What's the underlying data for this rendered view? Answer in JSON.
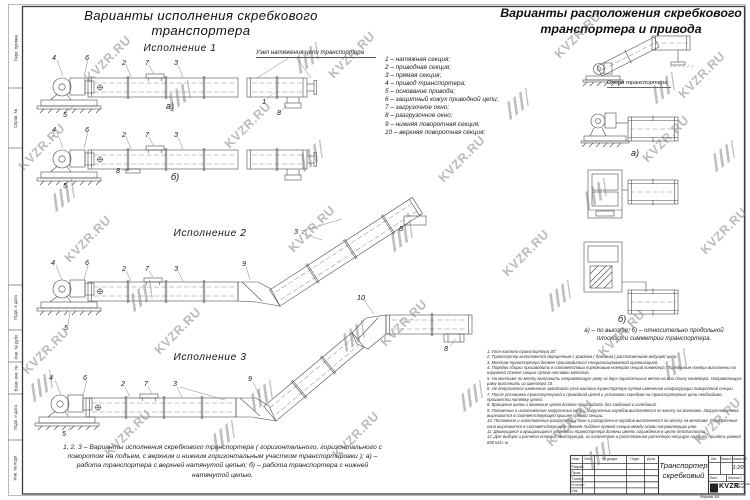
{
  "watermark": {
    "text": "KVZR.RU"
  },
  "titles": {
    "left": "Варианты исполнения скребкового транспортера",
    "right": "Варианты расположения скребкового\nтранспортера и привода"
  },
  "detail_heading": "Узел натяжения цепи транспортера",
  "legend": {
    "items": [
      "1 –  натяжная секция;",
      "2 –  приводная секция;",
      "3 –  прямая секция;",
      "4 –  привод транспортера;",
      "5 –  основание привода;",
      "6 –  защитный кожух приводной цепи;",
      "7 –  загрузочное окно;",
      "8 –  разгрузочное окно;",
      "9 –  нижняя поворотная секция;",
      "10 –  верхняя поворотная секция;"
    ]
  },
  "executions": {
    "e1": "Исполнение  1",
    "e2": "Исполнение  2",
    "e3": "Исполнение  3"
  },
  "sub_labels": {
    "a": "а)",
    "b": "б)"
  },
  "callouts": {
    "n1": "1",
    "n2": "2",
    "n3": "3",
    "n4": "4",
    "n5": "5",
    "n6": "6",
    "n7": "7",
    "n8": "8",
    "n9": "9",
    "n10": "10"
  },
  "right_panel": {
    "support_label": "Опора транспортера",
    "caption": "а) –  по высоте;  б) –  относительно продольной\nплоскости симметрии транспортера."
  },
  "bottom_caption": "1, 2, 3 –  Варианты исполнения скребкового транспортера ( горизонтального, горизонтального с\nповоротом на подъем, с верхним и нижним горизонтальным участком транспортировки );  а) –\nработа транспортера с верхней натянутой цепью;  б) –  работа транспортера с нижней\nнатянутой цепью.",
  "notes": {
    "items": [
      "1. Угол наклона транспортера 30°.",
      "2. Транспортер выполняется двухцепным с крайним ( боковым ) расположением ведущей цепи.",
      "3. Монтаж транспортера должен производиться специализированной организацией.",
      "4. Порядок сборки производить в соответствии порядковым номерам секций конвейера. Порядковые номера выполнены на наружной стенке секции путем наплавки металла.",
      "5. На монтаже по месту выполнить направляющую раму из двух параллельных веток на всю длину конвейера. Направляющую раму выполнить из швеллера 10.",
      "6. Не допускается изменение заводского угла наклона транспортера путем изменения конфигурации поворотной секции.",
      "7. После установки транспортерной и приводной цепей и установки скребков на транспортерные цепи необходимо произвести натяжку цепей.",
      "8. Вращение валов и движение цепей должно происходить без заеданий и колебаний.",
      "9. Положение и изготовление загрузочных окон и загрузочных коробов выполняется по месту на монтаже. Загрузочные окна вырезаются в соответствующей крышке прямой секции.",
      "10. Положение и изготовление разгрузочных окон и разгрузочных коробов выполняется по месту на монтаже. Разгрузочные окна вырезаются в соответствующем нижнем поддоне прямой секции между осями направляющих рам.",
      "11. Движущиеся и вращающиеся элементы транспортера должны иметь ограждения в целях безопасности.",
      "12. Для выбора и расчета опорных конструкций, их количества и расположения расчетную несущую нагрузку принять равной 600 кг/п. м."
    ]
  },
  "title_block": {
    "doc_title": "Транспортер\nскребковый",
    "cols": [
      "Изм.",
      "Лист",
      "№ докум.",
      "Подп.",
      "Дата"
    ],
    "rows": [
      "Разраб.",
      "Пров.",
      "Т.контр.",
      "Н.контр.",
      "Утв."
    ],
    "lit_label": "Лит.",
    "mass_label": "Масса",
    "scale_label": "Масштаб",
    "scale_value": "1:20",
    "sheet_label": "Лист",
    "sheets_label": "Листов",
    "sheets_value": "1",
    "logo_text": "KVZR",
    "logo_sub": "КОТЕЛЬНЫЙ ЗАВОД",
    "format_label": "Формат А3"
  },
  "margin_labels": {
    "items": [
      "Перв. примен.",
      "Справ. №",
      "Подп. и дата",
      "Инв. № дубл.",
      "Взам. инв. №",
      "Подп. и дата",
      "Инв. № подл."
    ]
  }
}
